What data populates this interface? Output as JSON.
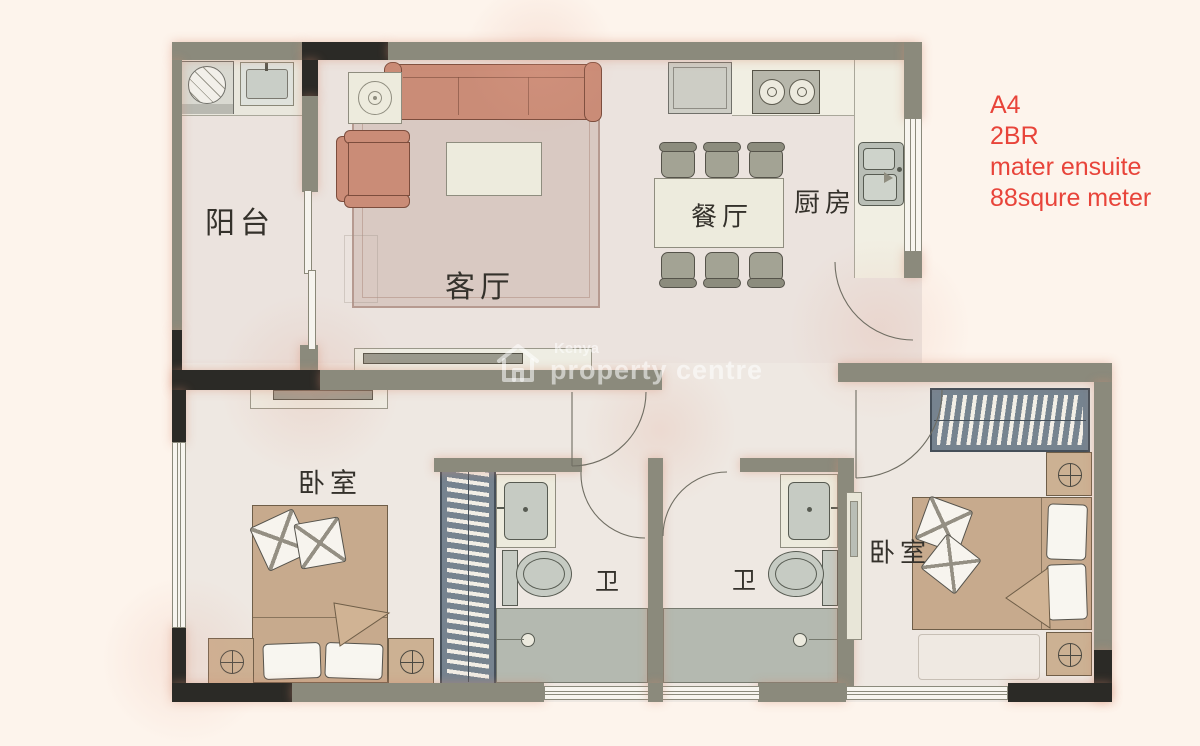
{
  "annotation": {
    "line1": "A4",
    "line2": "2BR",
    "line3": "mater ensuite",
    "line4": "88squre meter",
    "color": "#e8443a"
  },
  "watermark": {
    "brand_top": "Kenya",
    "brand_bottom": "property centre"
  },
  "rooms": {
    "balcony": "阳台",
    "living": "客厅",
    "dining": "餐厅",
    "kitchen": "厨房",
    "bedroom_left": "卧室",
    "bath_left": "卫",
    "bath_right": "卫",
    "master_bedroom": "卧室"
  },
  "colors": {
    "background": "#fdf4ec",
    "floor": "#ebe3de",
    "wall": "#8b8a7c",
    "wall_dark": "#2b2a26",
    "furniture_salmon": "#ca8c77",
    "furniture_tan": "#c7aa8d",
    "wardrobe_blue": "#76838f",
    "accent_red": "#e8443a"
  }
}
